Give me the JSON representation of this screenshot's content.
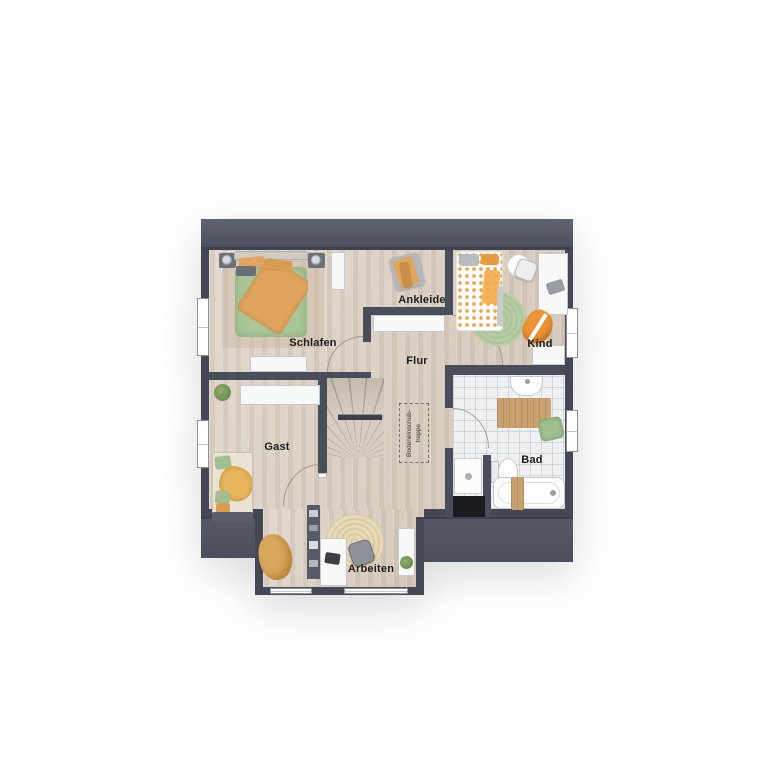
{
  "plan": {
    "title": "Obergeschoss Grundriss",
    "rooms": {
      "schlafen": "Schlafen",
      "ankleide": "Ankleide",
      "kind": "Kind",
      "flur": "Flur",
      "gast": "Gast",
      "bad": "Bad",
      "arbeiten": "Arbeiten"
    },
    "stairs": {
      "hatch_label_line1": "Bodeneinschub-",
      "hatch_label_line2": "treppe"
    },
    "colors": {
      "roof": "#565a68",
      "wall": "#4a4d5a",
      "floor_wood": "#dcd0c2",
      "floor_tile": "#eef0f2",
      "bed_green": "#a9c698",
      "bed_orange": "#e2a55f",
      "kid_orange": "#f0a84e",
      "rug_green": "#b7cda2",
      "wood_accessory": "#c9a171",
      "background": "#ffffff"
    }
  }
}
